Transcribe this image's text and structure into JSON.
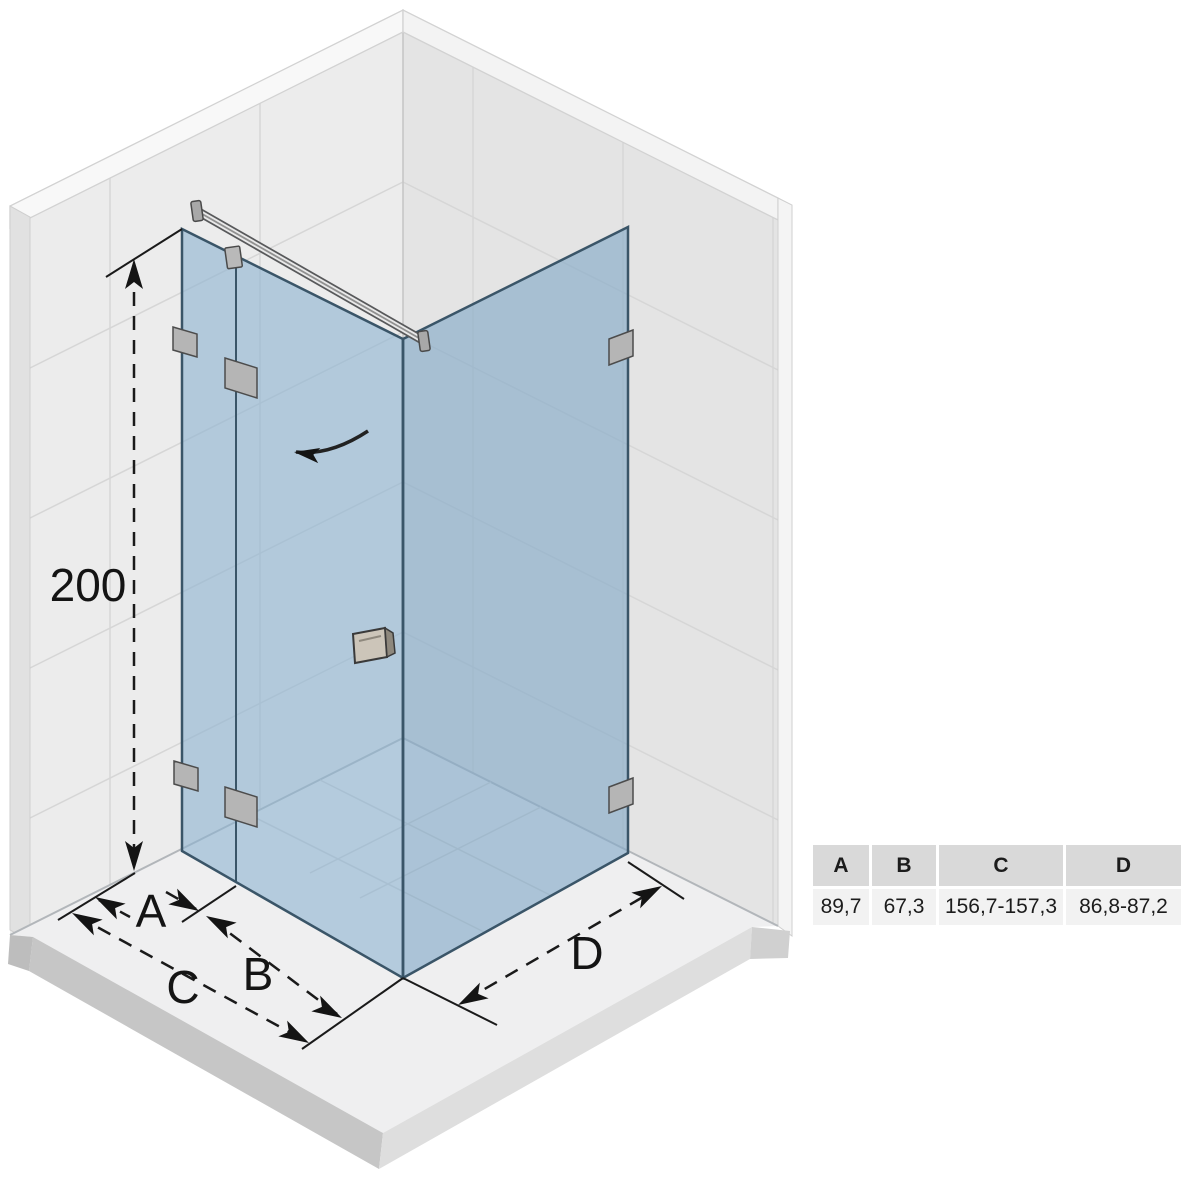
{
  "dimensions": {
    "height": {
      "label": "200"
    },
    "a": {
      "label": "A",
      "value": "89,7"
    },
    "b": {
      "label": "B",
      "value": "67,3"
    },
    "c": {
      "label": "C",
      "value": "156,7-157,3"
    },
    "d": {
      "label": "D",
      "value": "86,8-87,2"
    }
  },
  "table": {
    "headers": [
      "A",
      "B",
      "C",
      "D"
    ],
    "values": [
      "89,7",
      "67,3",
      "156,7-157,3",
      "86,8-87,2"
    ]
  },
  "colors": {
    "glass_fill": "#8cb2d0",
    "glass_edge": "#3a5568",
    "wall_left": "#ececec",
    "wall_right": "#e4e4e4",
    "wall_top": "#f8f8f8",
    "tile_line": "#d6d6d6",
    "floor_top": "#efeff0",
    "plinth_front_left": "#c6c6c6",
    "plinth_front_right": "#dedede",
    "metal": "#b5b5b5",
    "handle": "#ccc5b9",
    "dimension_ink": "#1a1a1a",
    "table_header_bg": "#d9d9d9",
    "table_value_bg": "#f2f2f2"
  }
}
